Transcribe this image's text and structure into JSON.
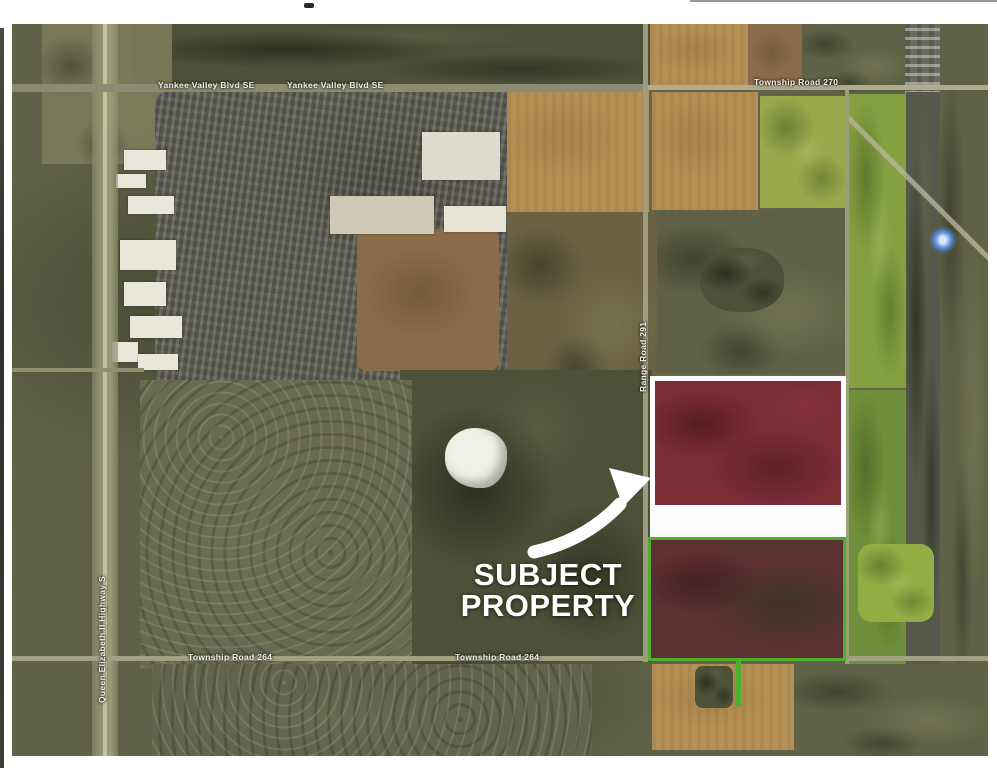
{
  "document": {
    "kind": "scanned aerial map exhibit",
    "location_context": "satellite photo with subject property highlighted"
  },
  "annotation": {
    "line1": "SUBJECT",
    "line2": "PROPERTY"
  },
  "road_labels": [
    {
      "id": "yankee-valley-blvd-west",
      "text": "Yankee Valley Blvd SE",
      "x": 158,
      "y": 80,
      "rot": 0
    },
    {
      "id": "yankee-valley-blvd-east",
      "text": "Yankee Valley Blvd SE",
      "x": 287,
      "y": 80,
      "rot": 0
    },
    {
      "id": "township-road-270",
      "text": "Township Road 270",
      "x": 754,
      "y": 77,
      "rot": 0
    },
    {
      "id": "township-road-264-west",
      "text": "Township Road 264",
      "x": 188,
      "y": 652,
      "rot": 0
    },
    {
      "id": "township-road-264-east",
      "text": "Township Road 264",
      "x": 455,
      "y": 652,
      "rot": 0
    },
    {
      "id": "queen-elizabeth-ii-highway",
      "text": "Queen Elizabeth II Highway S",
      "x": 97,
      "y": 703,
      "rot": -90
    },
    {
      "id": "range-road-291",
      "text": "Range Road 291",
      "x": 638,
      "y": 392,
      "rot": -90
    }
  ],
  "map_features": {
    "subject_parcel_north": "highlighted parcel with white border",
    "subject_parcel_south": "highlighted parcel with green border",
    "pointer_arrow": "white curved arrow",
    "pond": "small white pond",
    "blue_marker": "blue glow point"
  },
  "colors": {
    "page-bg": "#ffffff",
    "terrain-base": "#5f6246",
    "urban-gray": "#5e5e55",
    "field-tan": "#b49055",
    "field-green": "#85a040",
    "field-brown": "#8a6c48",
    "road-pale": "#a8a98a",
    "parcel-red": "#7c2e37",
    "parcel-dark-red": "#5b3134",
    "parcel-green-border": "#4fae2b",
    "annotation-white": "#ffffff",
    "marker-blue": "#5f8fdd",
    "label-text": "#f0efe6"
  }
}
